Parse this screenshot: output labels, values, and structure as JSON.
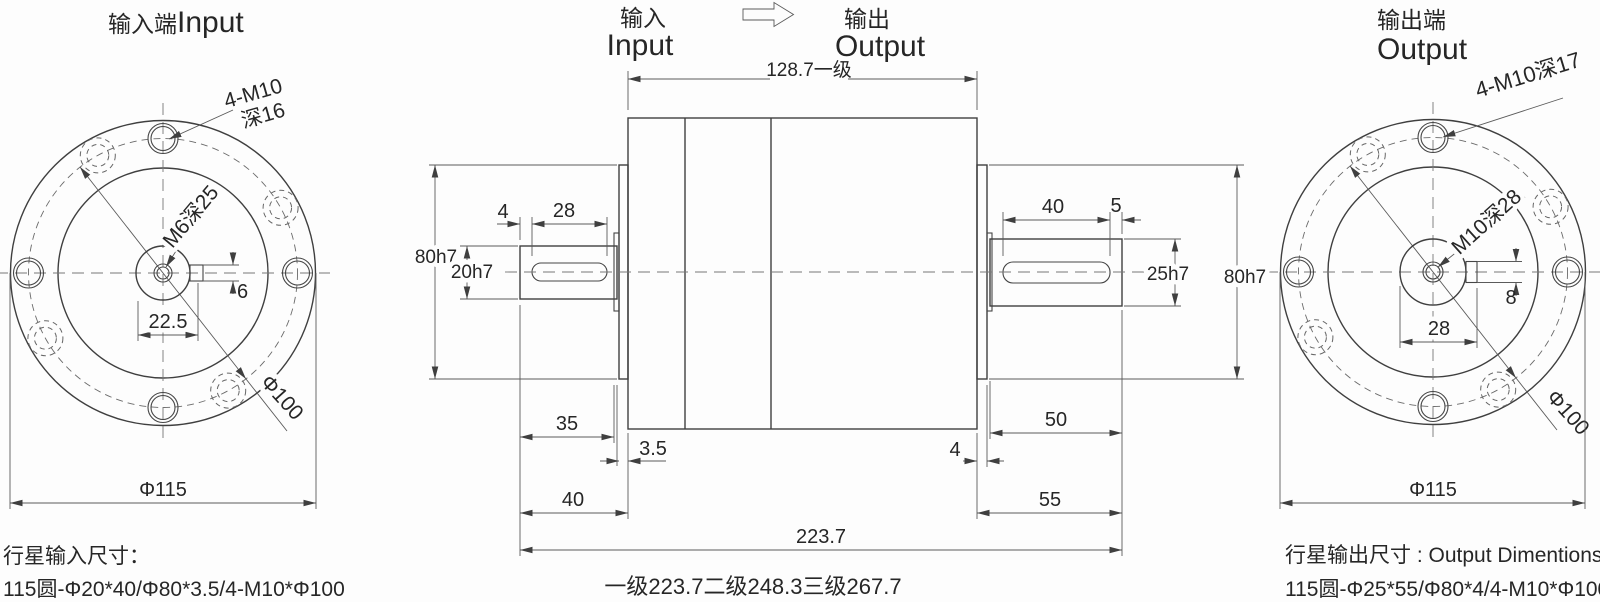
{
  "titles": {
    "left_zh": "输入端",
    "left_en": "Input",
    "mid_in_zh": "输入",
    "mid_in_en": "Input",
    "mid_out_zh": "输出",
    "mid_out_en": "Output",
    "right_zh": "输出端",
    "right_en": "Output"
  },
  "input_view": {
    "bolt_spec_line1": "4-M10",
    "bolt_spec_line2": "深16",
    "center_tap": "M6深25",
    "keyway_width": "6",
    "hub_width": "22.5",
    "bolt_circle_dia": "Φ100",
    "flange_dia": "Φ115",
    "note_title": "行星输入尺寸：",
    "note_spec": "115圆-Φ20*40/Φ80*3.5/4-M10*Φ100"
  },
  "side_view": {
    "stage1_body_length": "128.7一级",
    "input_key_offset": "4",
    "input_key_length": "28",
    "input_pilot_dia": "80h7",
    "input_shaft_dia": "20h7",
    "input_shaft_to_flange": "35",
    "input_flange_thickness": "3.5",
    "input_shaft_to_body": "40",
    "output_key_length": "40",
    "output_key_offset": "5",
    "output_shaft_dia": "25h7",
    "output_pilot_dia": "80h7",
    "output_flange_to_end": "50",
    "output_flange_thickness": "4",
    "output_body_to_end": "55",
    "total_length": "223.7",
    "stage_lengths_note": "一级223.7二级248.3三级267.7"
  },
  "output_view": {
    "bolt_spec": "4-M10深17",
    "center_tap": "M10深28",
    "keyway_width": "8",
    "hub_width": "28",
    "bolt_circle_dia": "Φ100",
    "flange_dia": "Φ115",
    "note_title": "行星输出尺寸 : Output Dimentions",
    "note_spec": "115圆-Φ25*55/Φ80*4/4-M10*Φ100"
  }
}
